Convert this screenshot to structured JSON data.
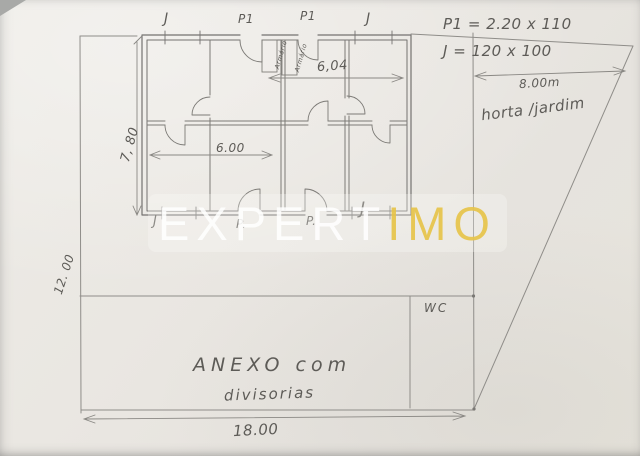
{
  "watermark": {
    "text_primary": "EXPERT",
    "text_accent": "IMO"
  },
  "floor_plan": {
    "top_labels": [
      "J",
      "P1",
      "P1",
      "J"
    ],
    "bottom_labels": [
      "J",
      "P.",
      "P.",
      "J"
    ],
    "closets": [
      "Armário",
      "Armário"
    ],
    "dims": {
      "height_left": "7, 80",
      "width_upper": "6,04",
      "width_lower": "6.00"
    }
  },
  "annotations": {
    "door_spec": "P1 = 2.20 x 110",
    "window_spec": "J = 120 x 100",
    "side_width": "8.00m",
    "garden": "horta /jardim"
  },
  "annex": {
    "title_line1": "ANEXO com",
    "title_line2": "divisorias",
    "wc": "WC",
    "width": "18.00",
    "height_left": "12. 00"
  },
  "colors": {
    "pencil": "#6f6d69",
    "accent_yellow": "#e7c44d",
    "paper": "#eae7e2"
  }
}
